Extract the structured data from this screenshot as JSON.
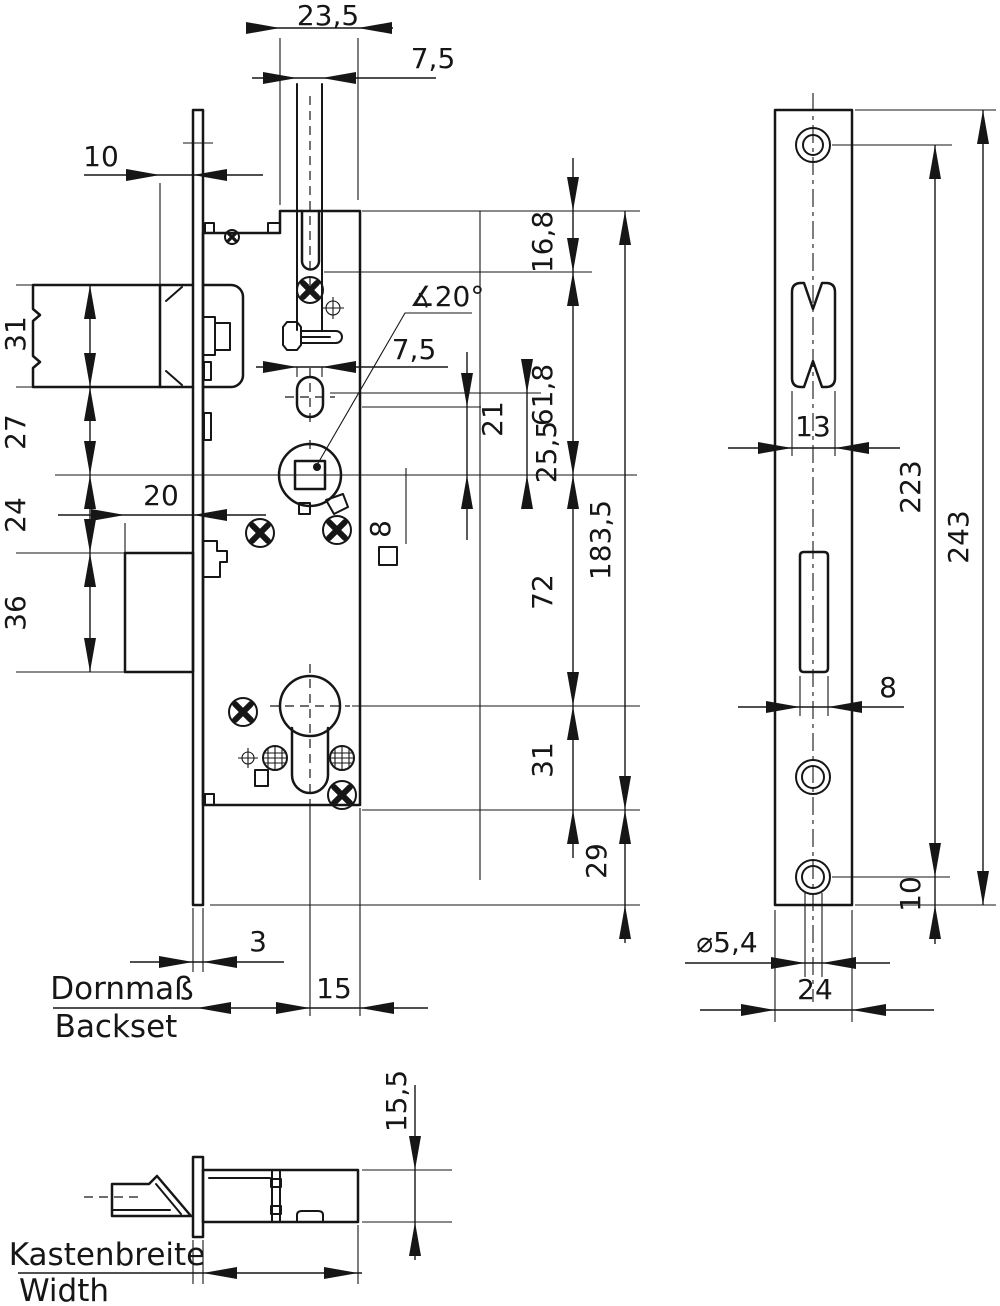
{
  "drawing": {
    "type": "technical-dimension-drawing",
    "subject": "Mortise lock with faceplate and side view",
    "units": "mm",
    "front": {
      "top_offset": "23,5",
      "guide_width_top": "7,5",
      "face_to_case": "10",
      "latch_height": "31",
      "latch_to_axis": "27",
      "axis_to_bolt": "24",
      "bolt_height": "36",
      "bolt_throw": "20",
      "cam_angle": "∡20°",
      "slot_width": "7,5",
      "oval_to_axis": "21",
      "dim_25_5": "25,5",
      "spindle_square": "8",
      "top_to_latch": "16,8",
      "latch_to_follower": "61,8",
      "follower_to_cylinder": "72",
      "cylinder_to_bottom": "31",
      "case_length": "183,5",
      "bottom_overhang": "29",
      "faceplate_thickness": "3",
      "axis_to_back": "15",
      "backset_label_de": "Dornmaß",
      "backset_label_en": "Backset"
    },
    "faceplate": {
      "latch_cutout_width": "13",
      "screw_distance": "223",
      "length": "243",
      "bolt_slot_width": "8",
      "screw_hole_dia": "⌀5,4",
      "width": "24",
      "screw_to_end": "10"
    },
    "side": {
      "case_depth": "15,5",
      "width_label_de": "Kastenbreite",
      "width_label_en": "Width"
    }
  }
}
